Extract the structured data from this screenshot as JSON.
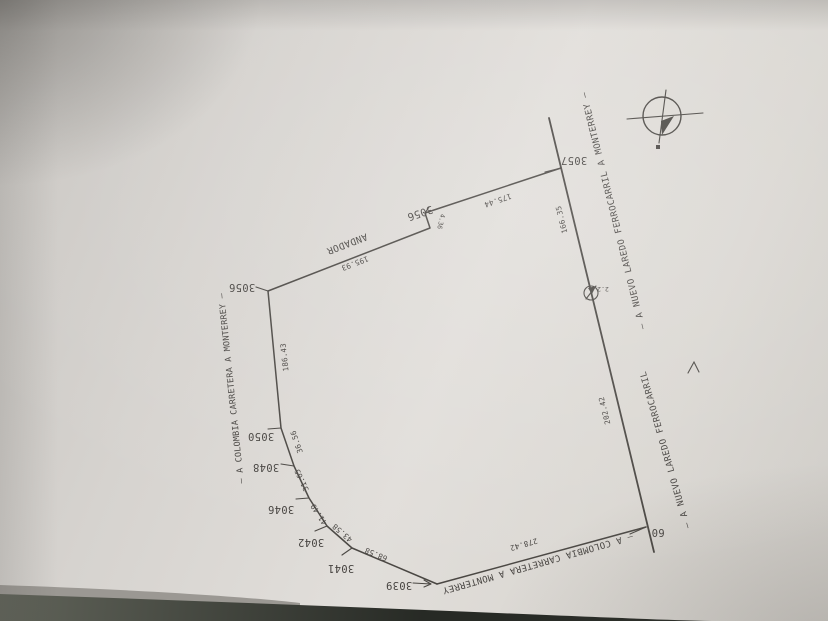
{
  "plat": {
    "streets": {
      "left_road": "— A COLOMBIA CARRETERA A MONTERREY —",
      "bottom_road": "— A COLOMBIA CARRETERA A MONTERREY",
      "railroad_upper": "— A NUEVO LAREDO FERROCARRIL A MONTERREY —",
      "railroad_lower": "— A NUEVO LAREDO FERROCARRIL",
      "walkway": "ANDADOR"
    },
    "lot_numbers": {
      "lot_3056_nw": "3056",
      "lot_3056_jog": "3056",
      "lot_3057": "3057",
      "lot_3050": "3050",
      "lot_3048": "3048",
      "lot_3046": "3046",
      "lot_3042": "3042",
      "lot_3041": "3041",
      "lot_3039": "3039",
      "corner_60": "60",
      "station_marker": "2.2"
    },
    "measurements": {
      "top_west": "195.93",
      "jog": "4.36",
      "top_east": "175.44",
      "rail_upper": "166.35",
      "rail_lower": "202.42",
      "west": "186.43",
      "seg_3050_3048": "36.56",
      "seg_3048_3046": "31.65",
      "seg_3046_3042": "41.49",
      "seg_3042_3041": "43.58",
      "seg_3041_3039": "68.58",
      "south": "278.42"
    }
  }
}
